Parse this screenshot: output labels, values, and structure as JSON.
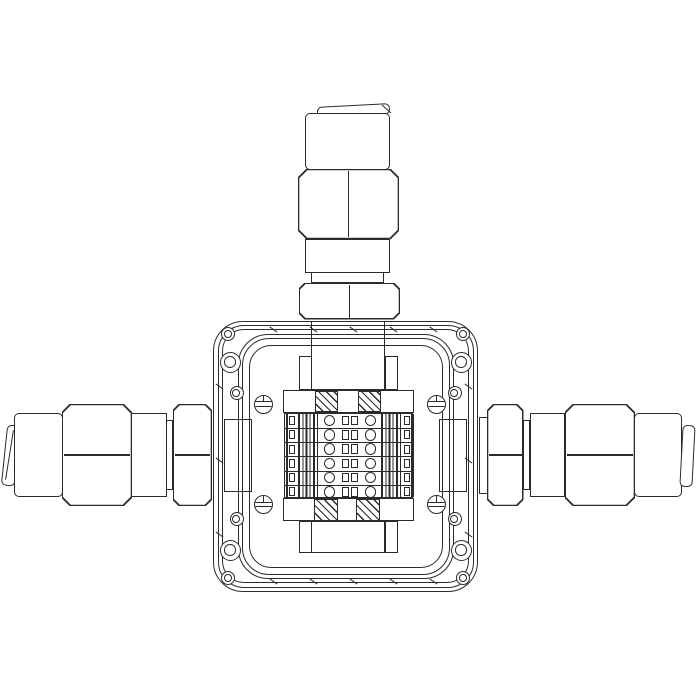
{
  "diagram": {
    "type": "technical line drawing",
    "subject": "Square junction box with internal screw-terminal block and three cable glands (top, left, right), front elevation view",
    "style": {
      "ink_color": "#2b2b2b",
      "background_color": "#ffffff"
    },
    "enclosure": {
      "label": "junction box enclosure",
      "shape": "rounded-corner square flange with inner cover",
      "body_outlines": 3,
      "cover_outlines": 3,
      "corner_hole_groups": 4,
      "small_holes_per_corner": 2,
      "large_screw_boss_per_corner": 1,
      "cover_screw_count": 4,
      "edge_tick_marks": {
        "top": 5,
        "bottom": 5,
        "left": 3,
        "right": 3
      }
    },
    "cable_glands": [
      {
        "position": "top",
        "parts": [
          "sealing-cap",
          "body-cylinder",
          "compression-nut-hex",
          "neck",
          "locknut-hex"
        ]
      },
      {
        "position": "left",
        "parts": [
          "sealing-cap",
          "body-cylinder",
          "compression-nut-hex",
          "neck",
          "locknut-hex"
        ]
      },
      {
        "position": "right",
        "parts": [
          "locknut-hex",
          "neck",
          "compression-nut-hex",
          "body-cylinder",
          "sealing-cap"
        ]
      }
    ],
    "gland_inner_ends": [
      "top",
      "left",
      "right"
    ],
    "terminal_block": {
      "label": "DIN-rail screw terminal block",
      "rows": 6,
      "screw_terminals_per_row": 2,
      "jumper_slots_per_row": 2,
      "clamp_tabs_per_side_per_row": 1,
      "side_stacks": 2,
      "end_brackets": {
        "count": 4,
        "fill": "diagonal-hatch"
      },
      "mounting_feet": {
        "top": true,
        "bottom": true
      }
    }
  }
}
